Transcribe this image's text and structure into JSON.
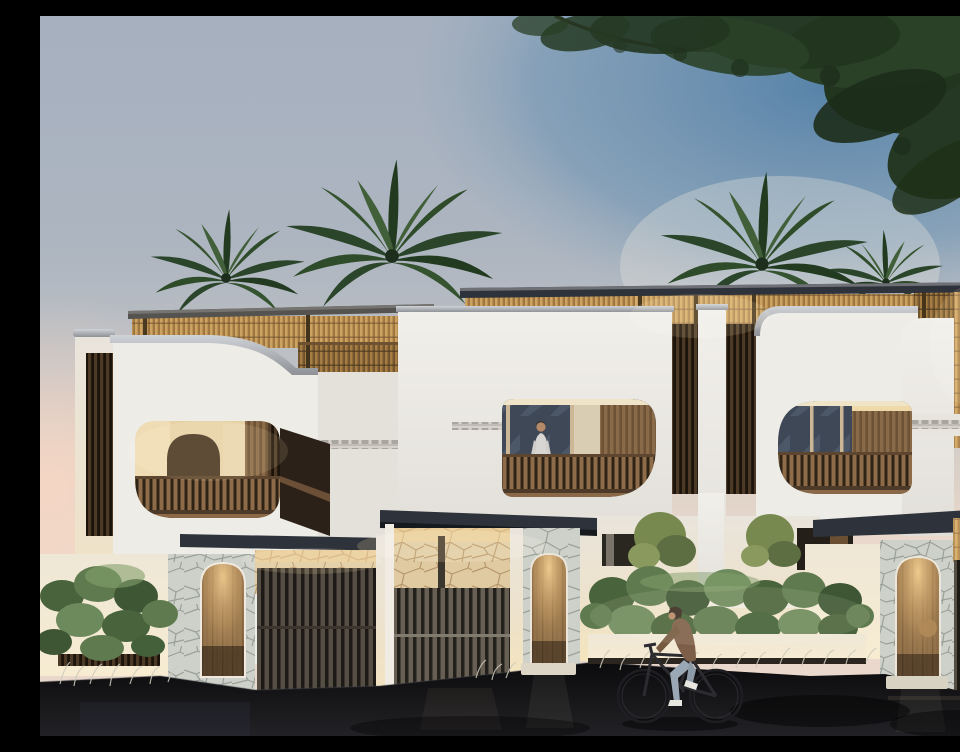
{
  "meta": {
    "title": "Modern tropical townhouse row at dusk",
    "type": "architectural-render",
    "time_of_day": "dusk"
  },
  "palette": {
    "sky_top": "#a6b0bf",
    "sky_mid": "#c0c2c5",
    "sky_horizon": "#e9d8cb",
    "sky_blue": "#4d7da6",
    "sky_pink": "#f6d6c4",
    "foliage_dark": "#22361f",
    "foliage_palm": "#2e4b2a",
    "wall_white": "#eeece7",
    "wall_recessed": "#e4e1db",
    "rattan": "#cda361",
    "wood_railing": "#8f6c49",
    "wood_louver": "#4c3a27",
    "canopy": "#2e333b",
    "stone_grey": "#cdd1ca",
    "stone_warm": "#dfcaa2",
    "street": "#131315",
    "glass": "#3f4856",
    "glow_warm": "#f3cf92",
    "door_wood": "#96754d",
    "skin": "#b68a68",
    "jacket_brown": "#7d5f49",
    "jeans_blue": "#9aa7b4",
    "grass_light": "#cfcabb"
  },
  "scene": {
    "description": "Three-unit white stucco villa row with rounded balcony openings, wooden slat railings and louvers, rattan roof pergolas, stone-clad entries with arched wooden doors, dark entry canopies, leafy planters, overhanging tree and rooftop palms against a dusk sky.",
    "elements": [
      "sky",
      "sunset-glow",
      "overhanging-tree",
      "palm-trees",
      "roof-pergolas",
      "villa-facades",
      "balconies",
      "louver-panels",
      "frieze-bands",
      "entry-canopies",
      "stone-walls",
      "arched-doors",
      "slat-gates",
      "planting",
      "street"
    ],
    "figures": {
      "balcony_person": {
        "location": "middle villa balcony",
        "top_color": "#d8d6d2",
        "pants_color": "#5f6570"
      },
      "cyclist": {
        "location": "street, riding left",
        "jacket_color": "#7d5f49",
        "pants_color": "#9aa7b4",
        "shoes_color": "#e8e6e0"
      }
    }
  }
}
